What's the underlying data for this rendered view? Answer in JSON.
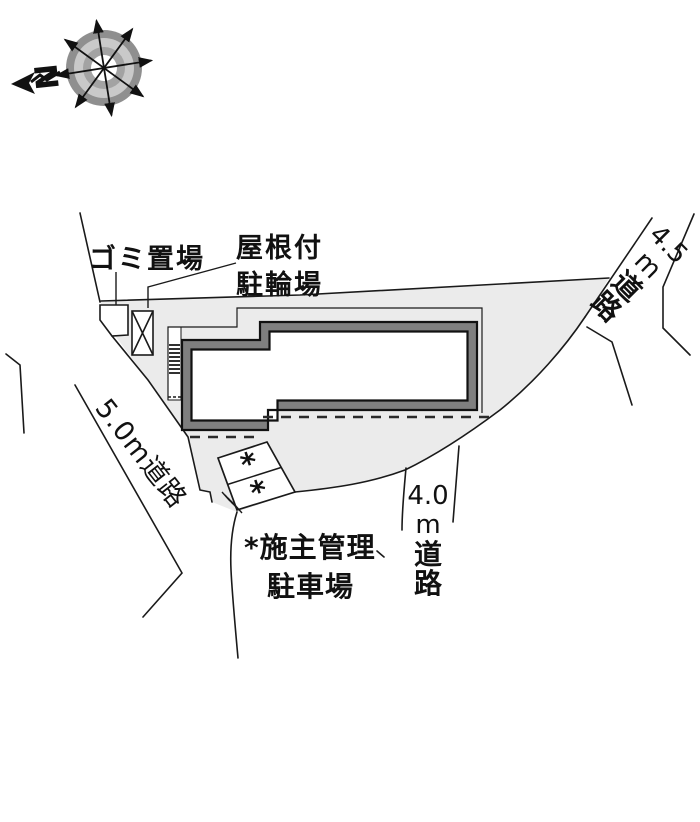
{
  "title": "site-plan",
  "compass": {
    "north": "N"
  },
  "labels": {
    "garbage": "ゴミ置場",
    "bike": [
      "屋根付",
      "駐輪場"
    ]
  },
  "roads": {
    "west": {
      "label": "5.0m道路"
    },
    "east": {
      "label": "4.5m道路",
      "stack": [
        "4.5",
        "m",
        "道",
        "路"
      ]
    },
    "south": {
      "label": "4.0m道路",
      "stack": [
        "4.0",
        "m",
        "道",
        "路"
      ]
    }
  },
  "parking": {
    "note": [
      "*施主管理",
      "駐車場"
    ],
    "stalls": [
      "*",
      "*"
    ]
  },
  "colors": {
    "site_fill": "#ebebeb",
    "building_wall": "#7f7f7f",
    "line": "#1a1a1a"
  }
}
